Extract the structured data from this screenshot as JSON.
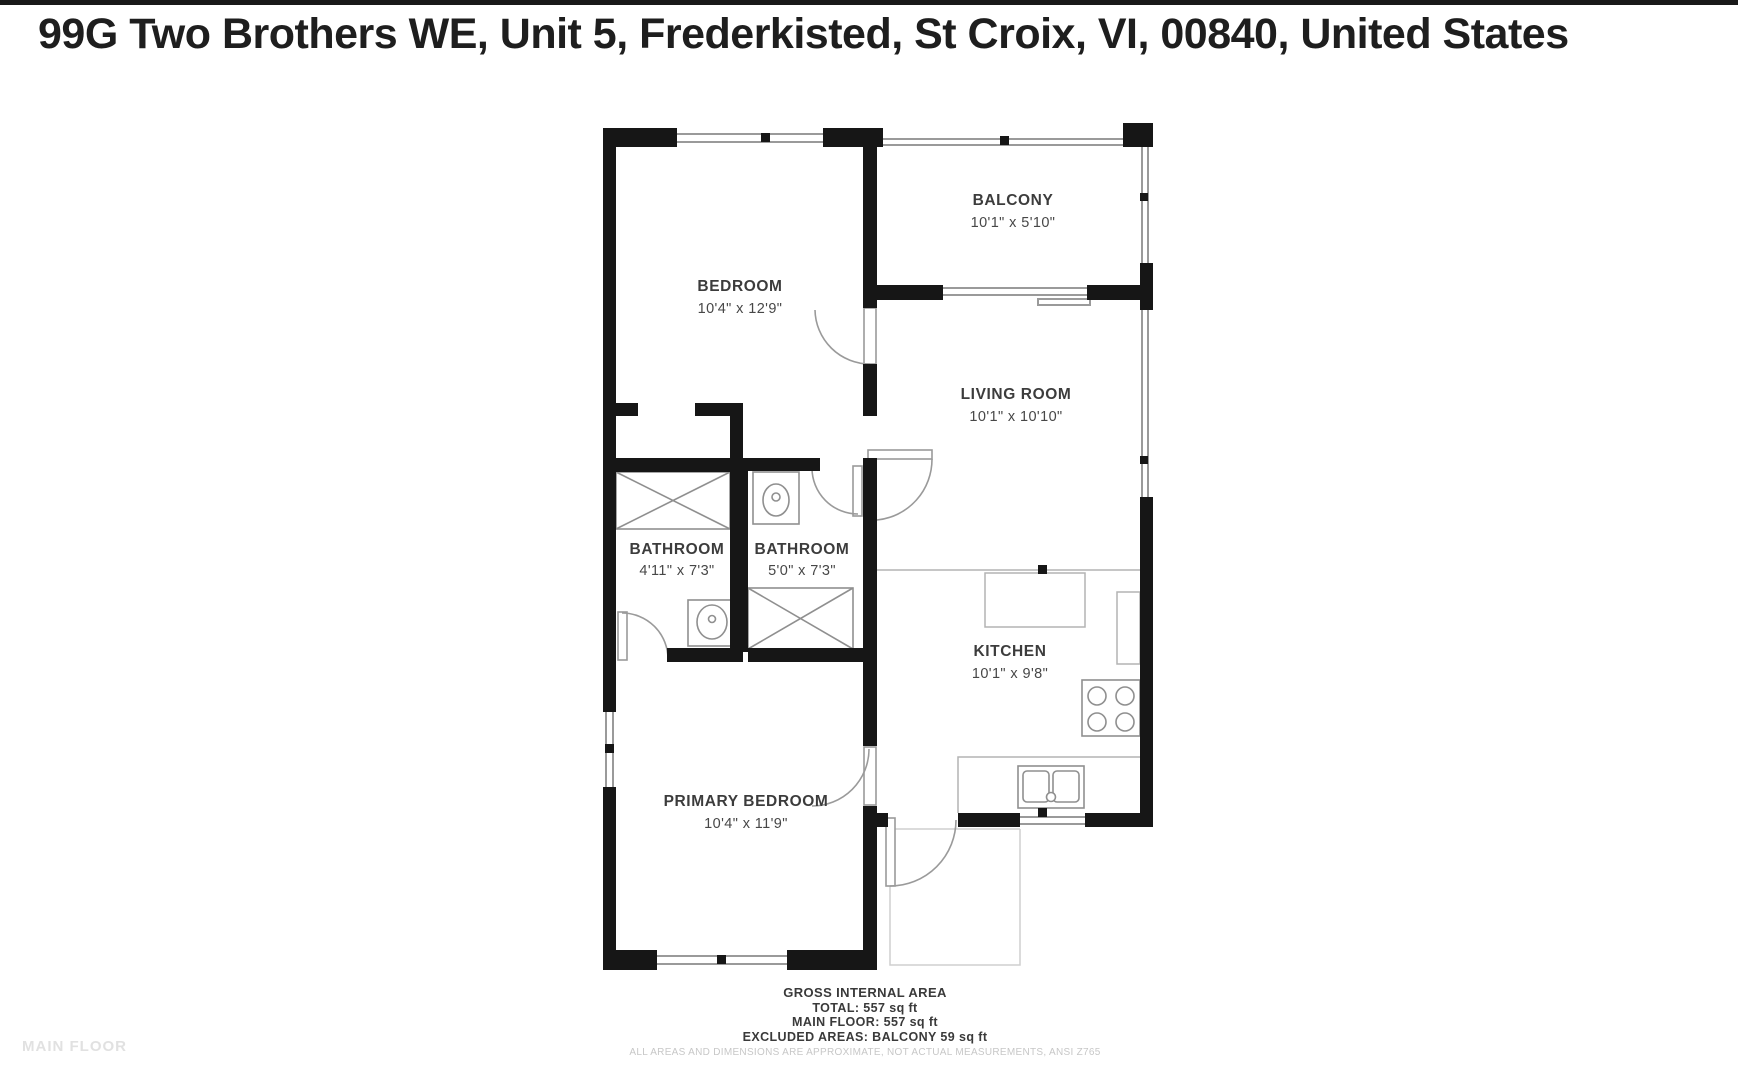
{
  "page": {
    "title": "99G Two Brothers WE, Unit 5, Frederkisted, St Croix, VI, 00840, United States",
    "watermark": "MAIN FLOOR"
  },
  "floor_plan": {
    "rooms": [
      {
        "name": "BEDROOM",
        "dims": "10'4\" x 12'9\""
      },
      {
        "name": "BALCONY",
        "dims": "10'1\" x 5'10\""
      },
      {
        "name": "LIVING ROOM",
        "dims": "10'1\" x 10'10\""
      },
      {
        "name": "BATHROOM",
        "dims": "4'11\" x 7'3\""
      },
      {
        "name": "BATHROOM",
        "dims": "5'0\" x 7'3\""
      },
      {
        "name": "KITCHEN",
        "dims": "10'1\" x 9'8\""
      },
      {
        "name": "PRIMARY BEDROOM",
        "dims": "10'4\" x 11'9\""
      }
    ],
    "colors": {
      "wall": "#161616",
      "thin_line": "#9a9a9a",
      "fixture": "#8f8f8f",
      "label_text": "#3c3c3c"
    }
  },
  "footer": {
    "heading": "GROSS INTERNAL AREA",
    "total": "TOTAL: 557 sq ft",
    "main_floor": "MAIN FLOOR: 557 sq ft",
    "excluded": "EXCLUDED AREAS: BALCONY 59 sq ft",
    "disclaimer": "ALL AREAS AND DIMENSIONS ARE APPROXIMATE, NOT ACTUAL MEASUREMENTS, ANSI Z765"
  }
}
